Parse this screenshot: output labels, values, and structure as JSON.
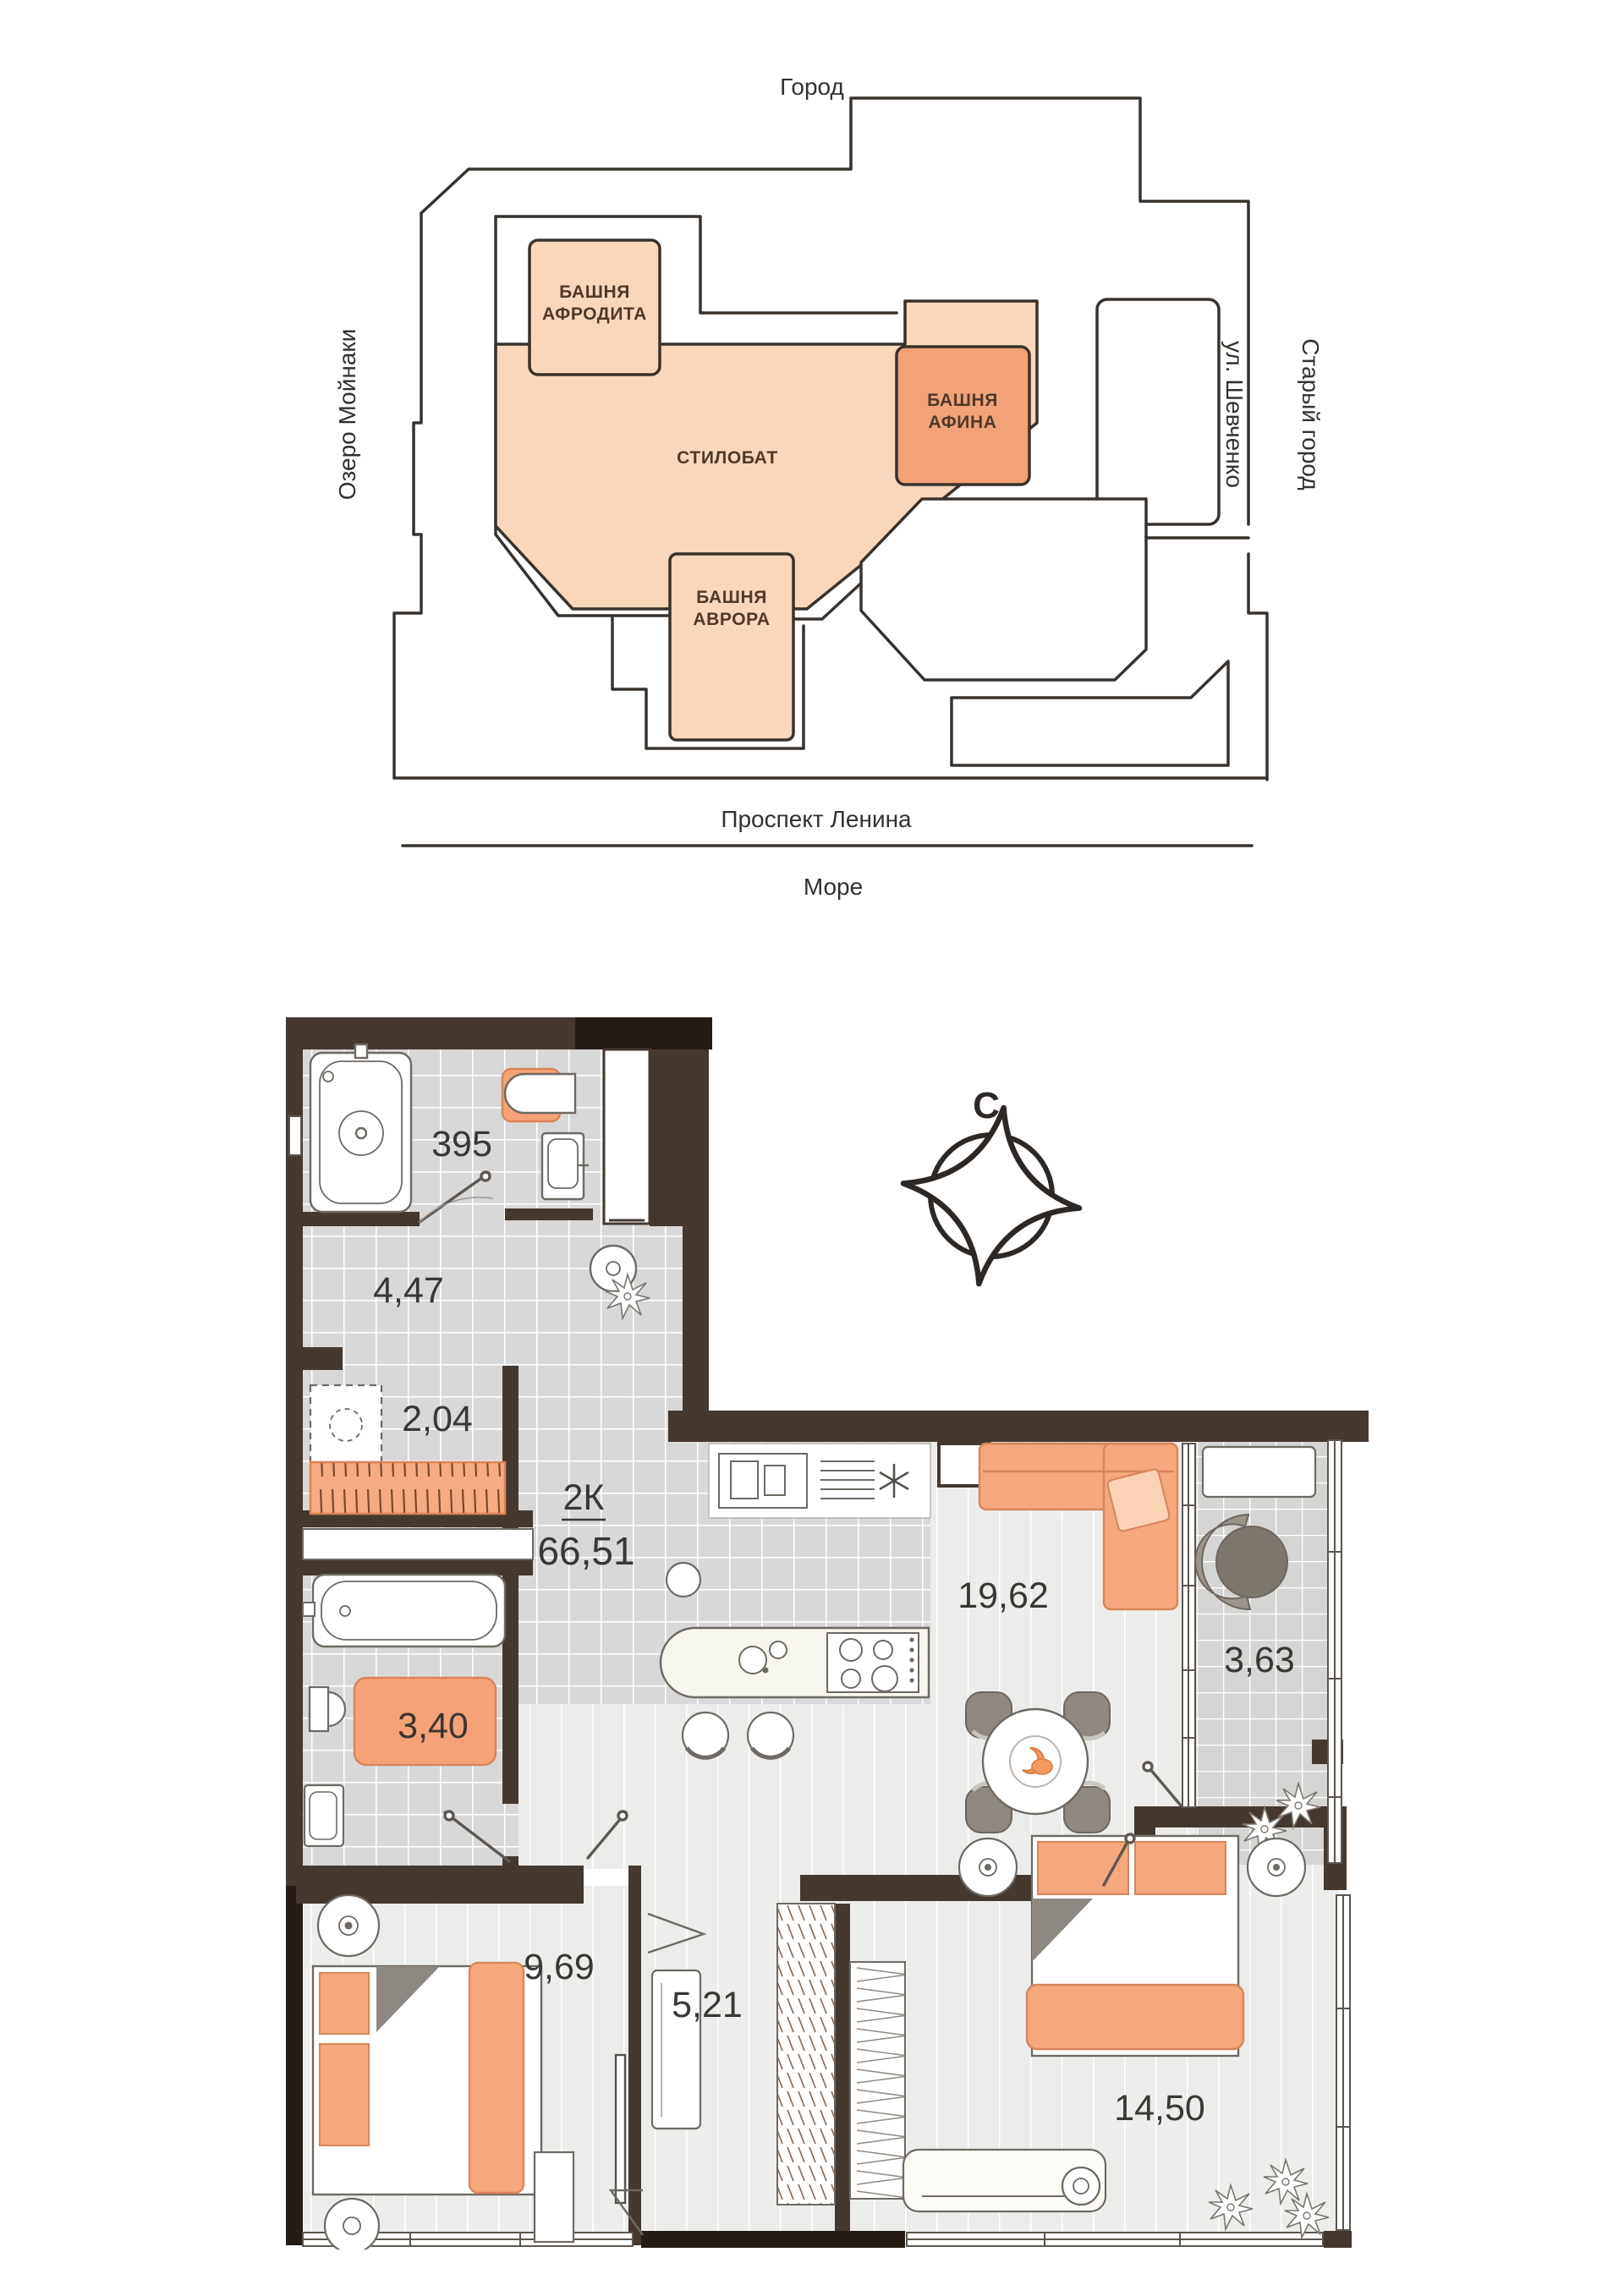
{
  "site_plan": {
    "city_label": "Город",
    "lake_label": "Озеро Мойнаки",
    "street_right_label": "ул. Шевченко",
    "old_town_label": "Старый город",
    "avenue_label": "Проспект Ленина",
    "sea_label": "Море",
    "towers": {
      "aphrodite_line1": "БАШНЯ",
      "aphrodite_line2": "АФРОДИТА",
      "athena_line1": "БАШНЯ",
      "athena_line2": "АФИНА",
      "stylobate": "СТИЛОБАТ",
      "aurora_line1": "БАШНЯ",
      "aurora_line2": "АВРОРА"
    },
    "colors": {
      "tower_fill": "#F8D7BC",
      "athena_fill": "#F2A276",
      "outline": "#38322D"
    }
  },
  "floor_plan": {
    "compass_north": "С",
    "type_label": "2К",
    "total_area": "66,51",
    "rooms": [
      {
        "name": "bathroom",
        "area": "395"
      },
      {
        "name": "hallway",
        "area": "4,47"
      },
      {
        "name": "wardrobe",
        "area": "2,04"
      },
      {
        "name": "bathroom-2",
        "area": "3,40"
      },
      {
        "name": "bedroom-1",
        "area": "9,69"
      },
      {
        "name": "hall",
        "area": "5,21"
      },
      {
        "name": "kitchen-living",
        "area": "19,62"
      },
      {
        "name": "balcony",
        "area": "3,63"
      },
      {
        "name": "bedroom-2",
        "area": "14,50"
      }
    ],
    "colors": {
      "wall": "#45382F",
      "accent": "#F7A77C",
      "tile": "#D8D8D8",
      "floor": "#ECEDEB"
    }
  }
}
